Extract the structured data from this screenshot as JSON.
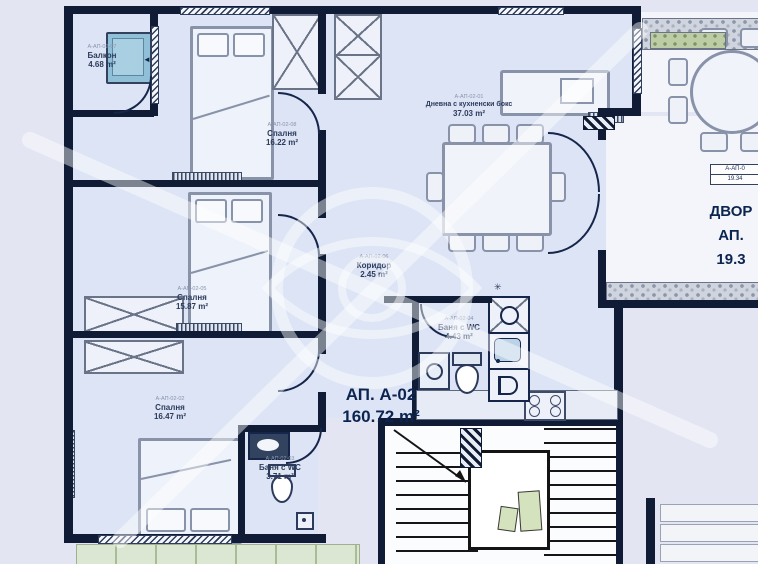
{
  "plan": {
    "apartment_label": {
      "title": "АП. А-02",
      "area": "160.72 m²"
    },
    "rooms": [
      {
        "id": "balcony",
        "code": "А-АП-02-07",
        "name": "Балкон",
        "area": "4.68 m²"
      },
      {
        "id": "bedroom-top",
        "code": "А-АП-02-08",
        "name": "Спалня",
        "area": "16.22 m²"
      },
      {
        "id": "living",
        "code": "А-АП-02-01",
        "name": "Дневна с кухненски бокс",
        "area": "37.03 m²"
      },
      {
        "id": "bedroom-middle",
        "code": "А-АП-02-05",
        "name": "Спалня",
        "area": "15.87 m²"
      },
      {
        "id": "corridor",
        "code": "А-АП-02-06",
        "name": "Коридор",
        "area": "2.45 m²"
      },
      {
        "id": "bath-main",
        "code": "А-АП-02-04",
        "name": "Баня с WC",
        "area": "4.43 m²"
      },
      {
        "id": "bedroom-bottom",
        "code": "А-АП-02-02",
        "name": "Спалня",
        "area": "16.47 m²"
      },
      {
        "id": "bath-small",
        "code": "А-АП-02-03",
        "name": "Баня с WC",
        "area": "3.71 m²"
      }
    ],
    "yard": {
      "tag_code": "А-АП-0",
      "tag_area": "19.34",
      "big_line1": "ДВОР",
      "big_line2": "АП.",
      "big_line3": "19.3"
    },
    "icons": {
      "window_arrow": "◄"
    },
    "colors": {
      "wall": "#101c36",
      "floor": "#dde4f5",
      "background": "#e3e6f2",
      "green": "#dbe7d2",
      "glass_blue": "#8fc0d8",
      "label_navy": "#0b2550"
    }
  }
}
